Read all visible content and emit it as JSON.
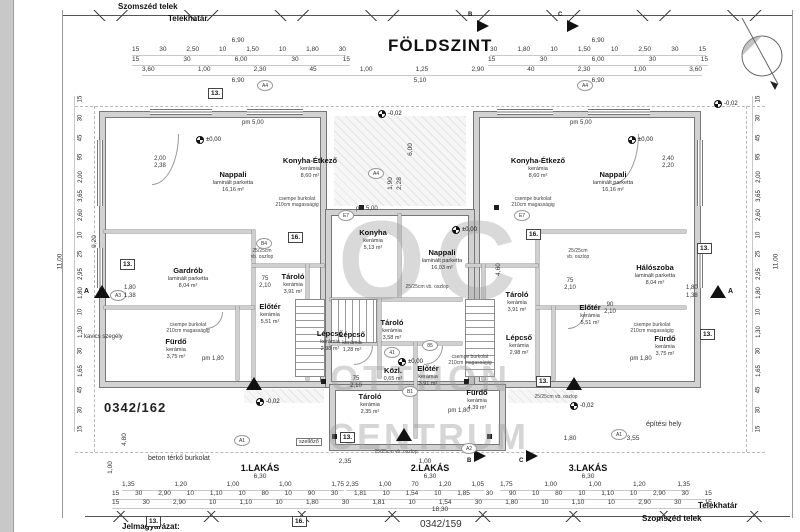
{
  "sheet": {
    "title": "FÖLDSZINT",
    "plot_number": "0342/162",
    "neighbor_plot": "0342/159",
    "legend": "Jelmagyarázat:"
  },
  "boundary": {
    "top_outer": "Szomszéd telek",
    "top_inner": "Telekhatár",
    "bottom_inner": "Telekhatár",
    "bottom_outer": "Szomszéd telek"
  },
  "site": {
    "paving": "beton térkő burkolat",
    "building_site": "építési hely",
    "gravel_edge": "kavics szegély",
    "vent": "szellőző",
    "column": "25/25cm vb. oszlop",
    "column_l1": "25/25cm",
    "column_l2": "vb. oszlop",
    "tile_l1": "csempe burkolat",
    "tile_l2": "210cm magasságig"
  },
  "levels": {
    "zero": "±0,00",
    "minus": "-0,02",
    "pm500": "pm 5,00",
    "pm180": "pm 1,80"
  },
  "watermark": {
    "big": "OC",
    "line1": "OTTHON",
    "line2": "CENTRUM"
  },
  "units": [
    {
      "label": "1.LAKÁS",
      "width": "6,30",
      "rooms": [
        {
          "name": "Nappali",
          "finish": "laminált parketta",
          "area": "16,16 m²"
        },
        {
          "name": "Konyha-Étkező",
          "finish": "kerámia",
          "area": "8,60 m²"
        },
        {
          "name": "Gardrób",
          "finish": "laminált parketta",
          "area": "8,04 m²"
        },
        {
          "name": "Fürdő",
          "finish": "kerámia",
          "area": "3,75 m²"
        },
        {
          "name": "Előtér",
          "finish": "kerámia",
          "area": "5,51 m²"
        },
        {
          "name": "Tároló",
          "finish": "kerámia",
          "area": "3,91 m²"
        },
        {
          "name": "Lépcső",
          "finish": "kerámia",
          "area": "2,98 m²"
        }
      ]
    },
    {
      "label": "2.LAKÁS",
      "width": "6,30",
      "rooms": [
        {
          "name": "Konyha",
          "finish": "kerámia",
          "area": "5,13 m²"
        },
        {
          "name": "Nappali",
          "finish": "laminált parketta",
          "area": "16,03 m²"
        },
        {
          "name": "Lépcső",
          "finish": "kerámia",
          "area": "1,28 m²"
        },
        {
          "name": "Tároló",
          "finish": "kerámia",
          "area": "3,58 m²"
        },
        {
          "name": "Közl.",
          "finish": "kerámia",
          "area": "0,65 m²"
        },
        {
          "name": "Előtér",
          "finish": "kerámia",
          "area": "3,91 m²"
        },
        {
          "name": "Tároló",
          "finish": "kerámia",
          "area": "2,35 m²"
        },
        {
          "name": "Fürdő",
          "finish": "kerámia",
          "area": "4,39 m²"
        }
      ]
    },
    {
      "label": "3.LAKÁS",
      "width": "6,30",
      "rooms": [
        {
          "name": "Konyha-Étkező",
          "finish": "kerámia",
          "area": "8,60 m²"
        },
        {
          "name": "Nappali",
          "finish": "laminált parketta",
          "area": "16,16 m²"
        },
        {
          "name": "Hálószoba",
          "finish": "laminált parketta",
          "area": "8,04 m²"
        },
        {
          "name": "Tároló",
          "finish": "kerámia",
          "area": "3,91 m²"
        },
        {
          "name": "Előtér",
          "finish": "kerámia",
          "area": "5,51 m²"
        },
        {
          "name": "Lépcső",
          "finish": "kerámia",
          "area": "2,98 m²"
        },
        {
          "name": "Fürdő",
          "finish": "kerámia",
          "area": "3,75 m²"
        }
      ]
    }
  ],
  "dims": {
    "top_total_left": "6,90",
    "top_total_right": "6,90",
    "top_center": "5,10",
    "top_row_left": [
      "15",
      "30",
      "2,50",
      "10",
      "1,50",
      "10",
      "1,80",
      "30"
    ],
    "top_row_right": [
      "30",
      "1,80",
      "10",
      "1,50",
      "10",
      "2,50",
      "30",
      "15"
    ],
    "top_row2_left": [
      "15",
      "30",
      "6,00",
      "30",
      "15"
    ],
    "top_row2_right": [
      "15",
      "30",
      "6,00",
      "30",
      "15"
    ],
    "top_row3": [
      "3,60",
      "1,00",
      "2,30",
      "45",
      "1,00",
      "1,25",
      "2,90",
      "40",
      "2,30",
      "1,00",
      "3,60"
    ],
    "bottom_row1_left": [
      "1,35",
      "1,20",
      "1,00",
      "1,00",
      "1,75"
    ],
    "bottom_row1_mid": [
      "2,35",
      "1,00",
      "70",
      "1,20",
      "1,05"
    ],
    "bottom_row1_right": [
      "1,75",
      "1,00",
      "1,00",
      "1,20",
      "1,35"
    ],
    "bottom_row2": [
      "15",
      "30",
      "2,90",
      "10",
      "1,10",
      "10",
      "80",
      "10",
      "90",
      "30",
      "1,81",
      "10",
      "1,54",
      "10",
      "1,85",
      "30",
      "90",
      "10",
      "80",
      "10",
      "1,10",
      "10",
      "2,90",
      "30",
      "15"
    ],
    "bottom_row3": [
      "15",
      "30",
      "2,90",
      "10",
      "1,10",
      "10",
      "1,80",
      "30",
      "1,81",
      "10",
      "1,54",
      "30",
      "1,80",
      "10",
      "1,10",
      "10",
      "2,90",
      "30",
      "15"
    ],
    "bottom_total": "18,30",
    "left_total": "11,00",
    "left_sub": "9,20",
    "left_chain": [
      "15",
      "30",
      "45",
      "95",
      "2,00",
      "3,65",
      "2,60",
      "10",
      "25",
      "2,95",
      "1,80",
      "10",
      "1,30",
      "30",
      "1,65",
      "45",
      "30",
      "15"
    ],
    "right_chain": [
      "15",
      "30",
      "45",
      "95",
      "2,00",
      "3,65",
      "2,60",
      "10",
      "25",
      "2,95",
      "1,80",
      "10",
      "1,30",
      "30",
      "1,65",
      "45",
      "30",
      "15"
    ],
    "right_total": "11,00",
    "court_h": "6,00",
    "mid_h": "4,60",
    "apron_h": "4,80",
    "offset_one": "1,00",
    "win_l1": "2,00",
    "win_l2": "2,38",
    "win_r1": "2,40",
    "win_r2": "2,20",
    "door_w": "75",
    "door_h": "2,10",
    "door_w2": "90",
    "court_w1": "1,90",
    "court_w2": "2,28",
    "b_235": "2,35",
    "b_100": "1,00",
    "b_180": "1,80",
    "b_355": "3,55",
    "sec_180": "1,80",
    "sec_138": "1,38"
  },
  "markers": {
    "bubbles": [
      "A4",
      "A4",
      "A4",
      "B4",
      "B1",
      "A1",
      "A1",
      "A2",
      "A3",
      "41",
      "85",
      "E7",
      "E7"
    ],
    "boxes": [
      "13.",
      "13.",
      "16.",
      "16.",
      "13.",
      "13.",
      "13.",
      "13.",
      "13.",
      "16."
    ],
    "sections": {
      "a": "A",
      "b": "B",
      "c": "C"
    }
  }
}
